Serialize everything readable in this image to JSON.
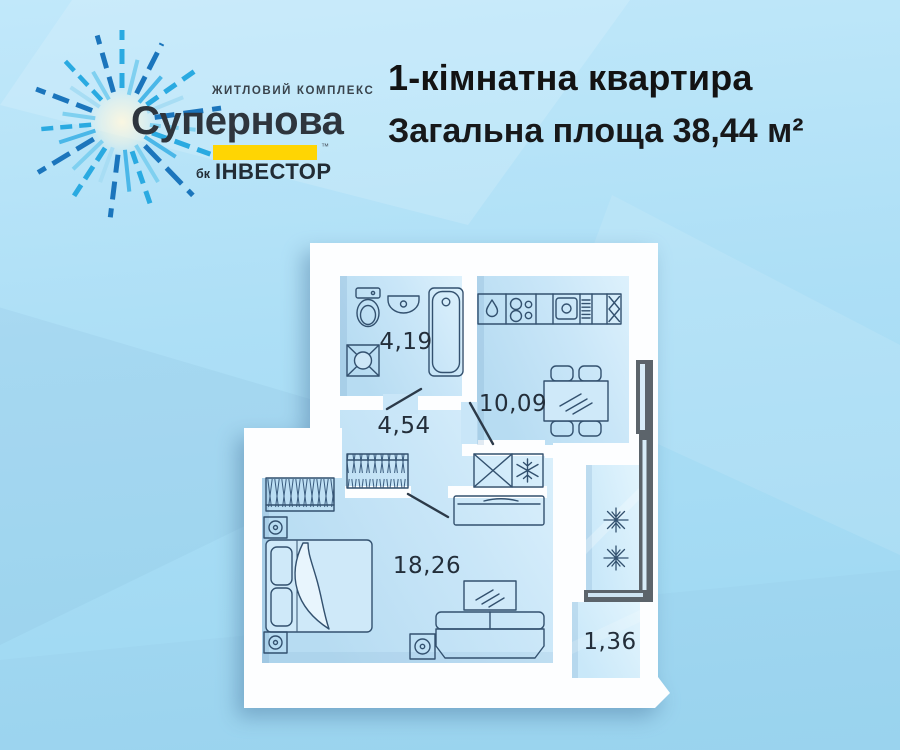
{
  "logo": {
    "complex_label": "ЖИТЛОВИЙ КОМПЛЕКС",
    "name": "Супернова",
    "trademark": "™",
    "developer_prefix": "бк",
    "developer_name": "ІНВЕСТОР",
    "accent_color": "#ffd503",
    "ray_colors": [
      "#1b75bc",
      "#2aaae1",
      "#7fd0f0",
      "#4ab7e8",
      "#a8ddf4"
    ]
  },
  "header": {
    "title": "1-кімнатна квартира",
    "subtitle": "Загальна площа 38,44 м²"
  },
  "floorplan": {
    "rooms": [
      {
        "id": "bathroom",
        "area": "4,19"
      },
      {
        "id": "hallway",
        "area": "4,54"
      },
      {
        "id": "kitchen",
        "area": "10,09"
      },
      {
        "id": "living-room",
        "area": "18,26"
      },
      {
        "id": "balcony",
        "area": "1,36"
      }
    ],
    "colors": {
      "wall": "#fdfeff",
      "floor": "#c9e6f8",
      "outline": "#33516f",
      "frame": "#5c646b",
      "label": "#232e3a"
    }
  }
}
